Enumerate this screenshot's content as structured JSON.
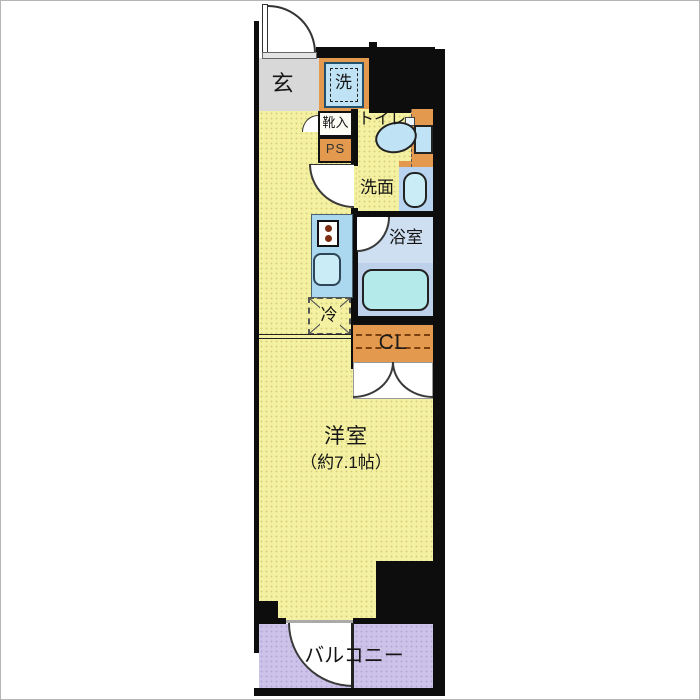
{
  "plan": {
    "rooms": {
      "genkan": {
        "label": "玄"
      },
      "washer": {
        "label": "洗"
      },
      "shoe_storage": {
        "label": "靴入"
      },
      "pipe_space": {
        "label": "PS"
      },
      "toilet": {
        "label": "トイレ"
      },
      "washroom": {
        "label": "洗面"
      },
      "bathroom": {
        "label": "浴室"
      },
      "refrigerator": {
        "label": "冷"
      },
      "closet": {
        "label": "CL"
      },
      "main_room": {
        "label": "洋室",
        "size": "（約7.1帖）"
      },
      "balcony": {
        "label": "バルコニー"
      }
    },
    "palette": {
      "wall": "#0d0d0d",
      "floor_yellow": "#f5f1a2",
      "genkan_gray": "#d8d8d8",
      "accent_orange": "#e39a4e",
      "fixture_blue": "#bfe2f5",
      "bath_pale_blue": "#cfdff2",
      "bath_lower_blue": "#bdd1ea",
      "tub_cyan": "#b5eaea",
      "balcony_purple": "#cdc3e9",
      "counter_blue": "#abd7ef",
      "sink_cyan": "#c9ecf6",
      "basin_zone_blue": "#b8d4f0",
      "burner_brown": "#7c2d12",
      "cl_dash_brown": "#7a3f10"
    }
  }
}
